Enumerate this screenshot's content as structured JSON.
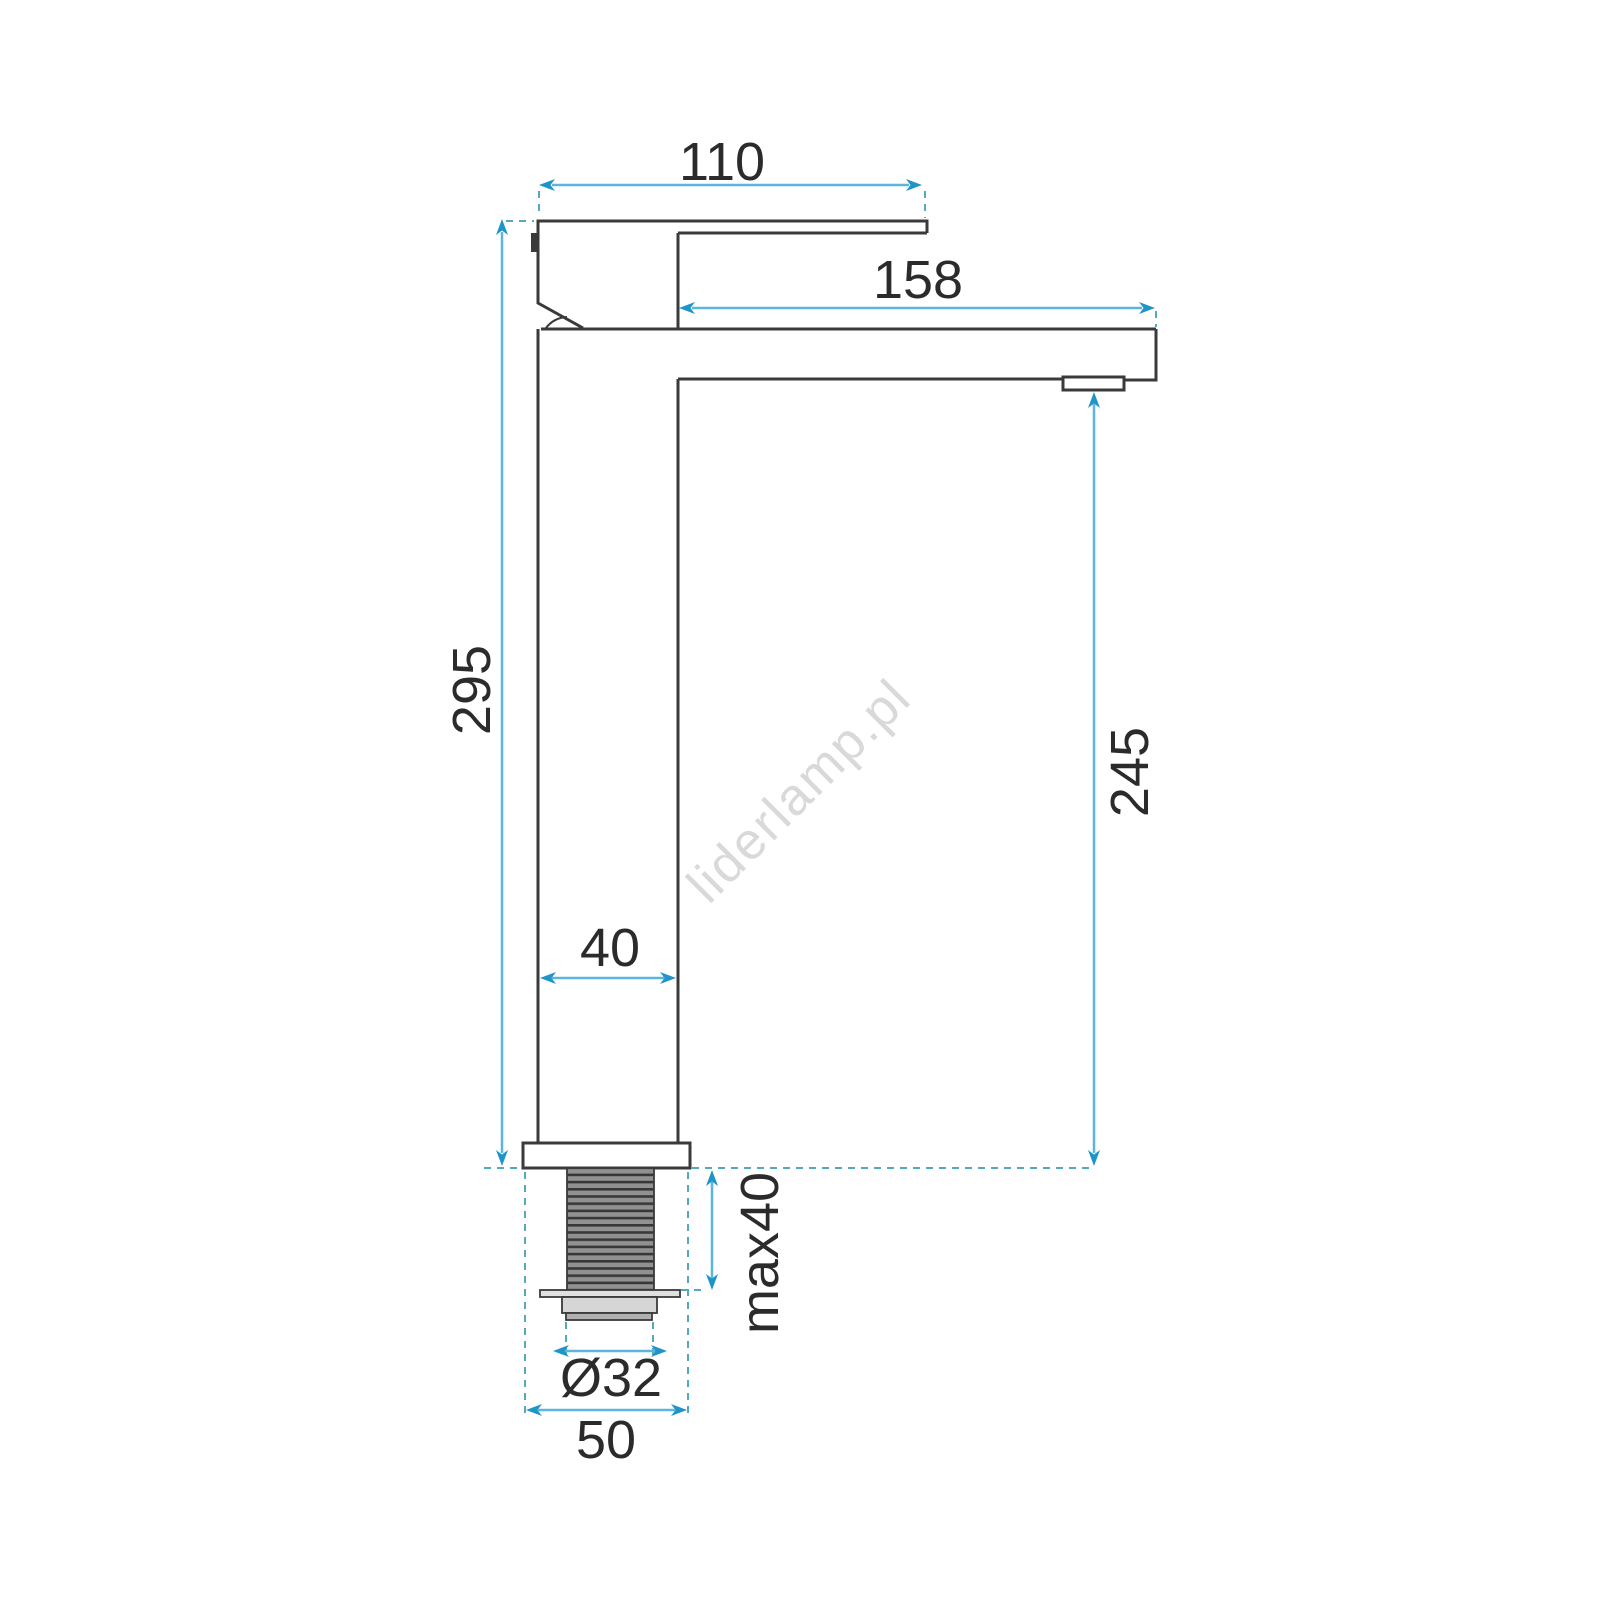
{
  "drawing": {
    "subject": "tall-single-lever-basin-faucet-side-view-technical-drawing",
    "watermark": "liderlamp.pl",
    "dimensions": {
      "handle_length": "110",
      "spout_reach": "158",
      "total_height": "295",
      "spout_height": "245",
      "body_width": "40",
      "max_mounting_thickness": "max40",
      "thread_diameter": "Ø32",
      "base_diameter": "50"
    },
    "colors": {
      "dimension_line": "#5bb5dc",
      "arrowhead": "#1e94c8",
      "extension_dash": "#55a8be",
      "outline": "#3a3a3a",
      "thread_dark": "#383838",
      "thread_gray": "#919191",
      "watermark": "#d9d9d9",
      "text": "#2b2b2b"
    }
  }
}
